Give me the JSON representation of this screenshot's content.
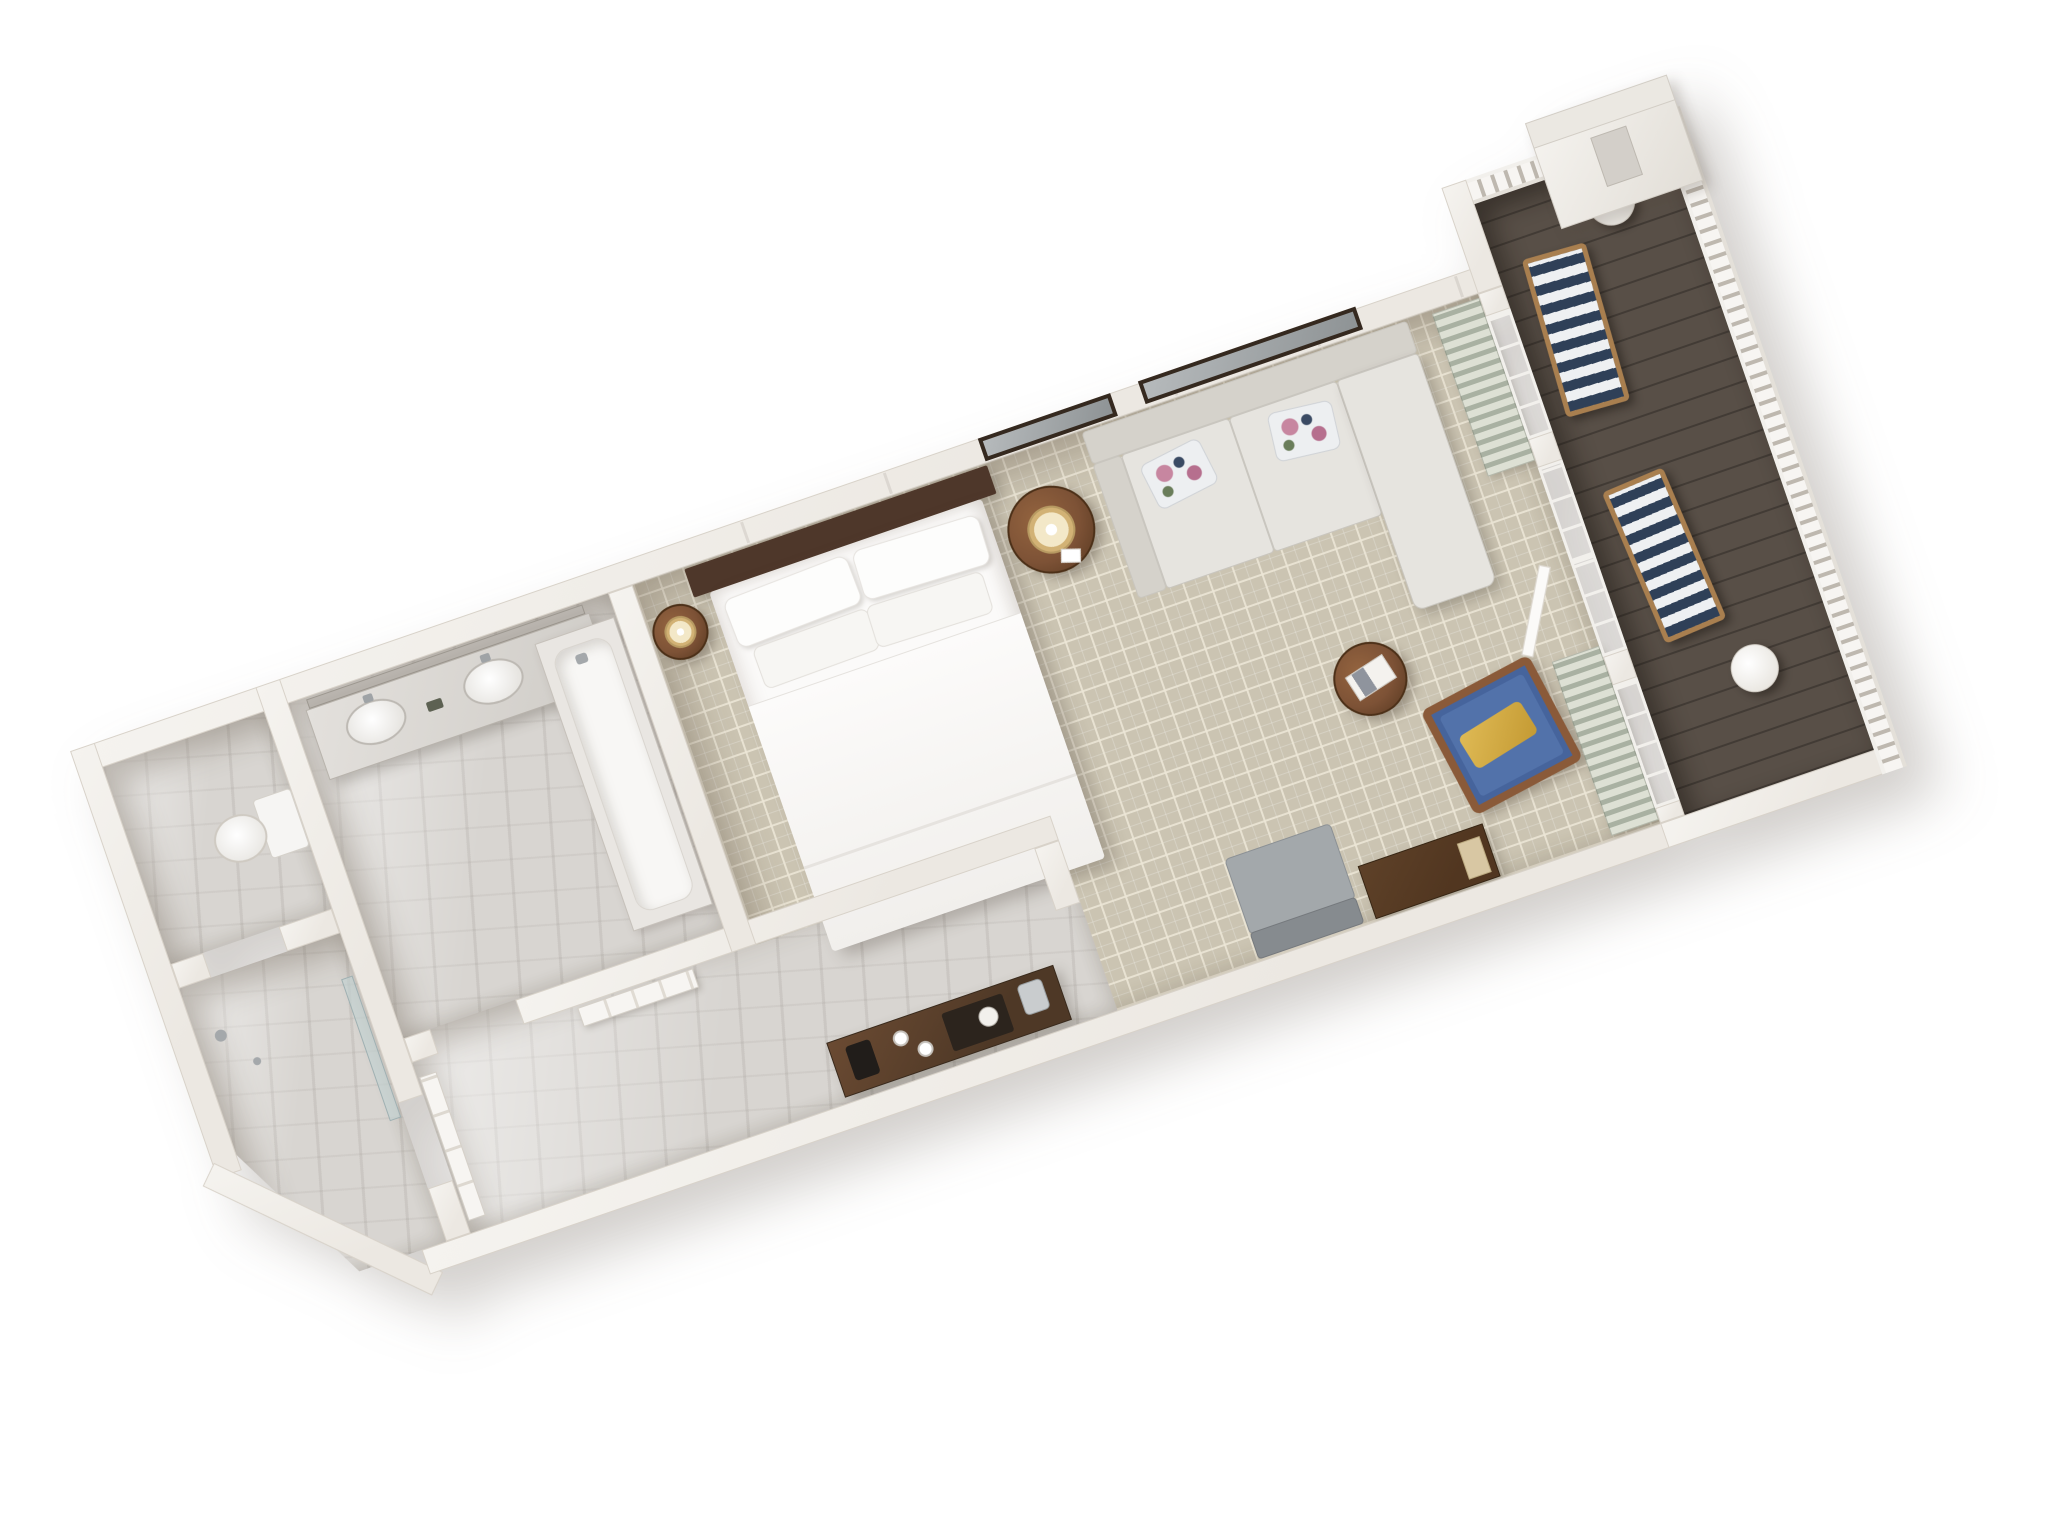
{
  "scene": {
    "label": "3D isometric floor plan render of a hotel guest room suite with balcony",
    "view": "top-down 3D cutaway, rotated diagonally on white background"
  },
  "palette": {
    "wall": "#ece8e2",
    "wall_edge": "#d8d2c9",
    "marble": "#d8d5d1",
    "carpet": "#cbc4b2",
    "carpet_line": "rgba(236,230,214,0.85)",
    "balcony_floor": "#584f47",
    "wood": "#7d5236",
    "wood_dark": "#513620",
    "headboard": "#4e372a",
    "sofa_a": "#e6e4df",
    "glass_a": "#8b8e92",
    "glass_b": "#6b6e72",
    "curtain_a": "#dde0d4",
    "curtain_b": "#a9b1a2",
    "navy": "#2f4058",
    "stripe_white": "#eef0f2",
    "gold": "#d2b275",
    "chair_blue": "#46649c",
    "railing_dark": "#beb8af",
    "frame_dark": "#35291f"
  },
  "rooms": {
    "water_closet": {
      "label": "Water closet",
      "items": {
        "toilet": "Toilet"
      }
    },
    "shower_room": {
      "label": "Shower room",
      "items": {
        "shower": "Walk-in shower with glass panel"
      }
    },
    "bathroom": {
      "label": "Bathroom",
      "items": {
        "vanity": "Double-sink marble vanity",
        "mirror": "Vanity mirror",
        "bathtub": "Built-in bathtub"
      }
    },
    "entry_hall": {
      "label": "Entry hall",
      "items": {
        "entry_door": "Entry door",
        "closet": "Closet doors",
        "console": "Console table with coffee and ice service"
      }
    },
    "bedroom": {
      "label": "Bedroom and sitting area",
      "items": {
        "bed": "King bed with white bedding",
        "headboard": "Dark wood headboard",
        "nightstand_left": "Round drum nightstand with lamp",
        "nightstand_right": "Round drum nightstand with lamp",
        "sofa": "Sectional sofa with chaise",
        "floral_pillow": "Floral accent pillow",
        "art_bed": "Framed artwork",
        "mirror_sofa": "Framed mirror",
        "ottoman": "Round wood side table with magazine",
        "armchair": "Blue wood-frame lounge chair with gold pillow",
        "gray_chair": "Upholstered slipper chair",
        "dresser": "Dark wood dresser",
        "curtains": "Striped drapes",
        "windows": "Window",
        "french_doors": "French doors to balcony"
      }
    },
    "balcony": {
      "label": "Balcony",
      "items": {
        "chaise": "Striped cushioned lounge chair",
        "side_table": "Round white side table",
        "railing": "White balustrade railing",
        "chimney": "Chimney stack"
      }
    }
  }
}
